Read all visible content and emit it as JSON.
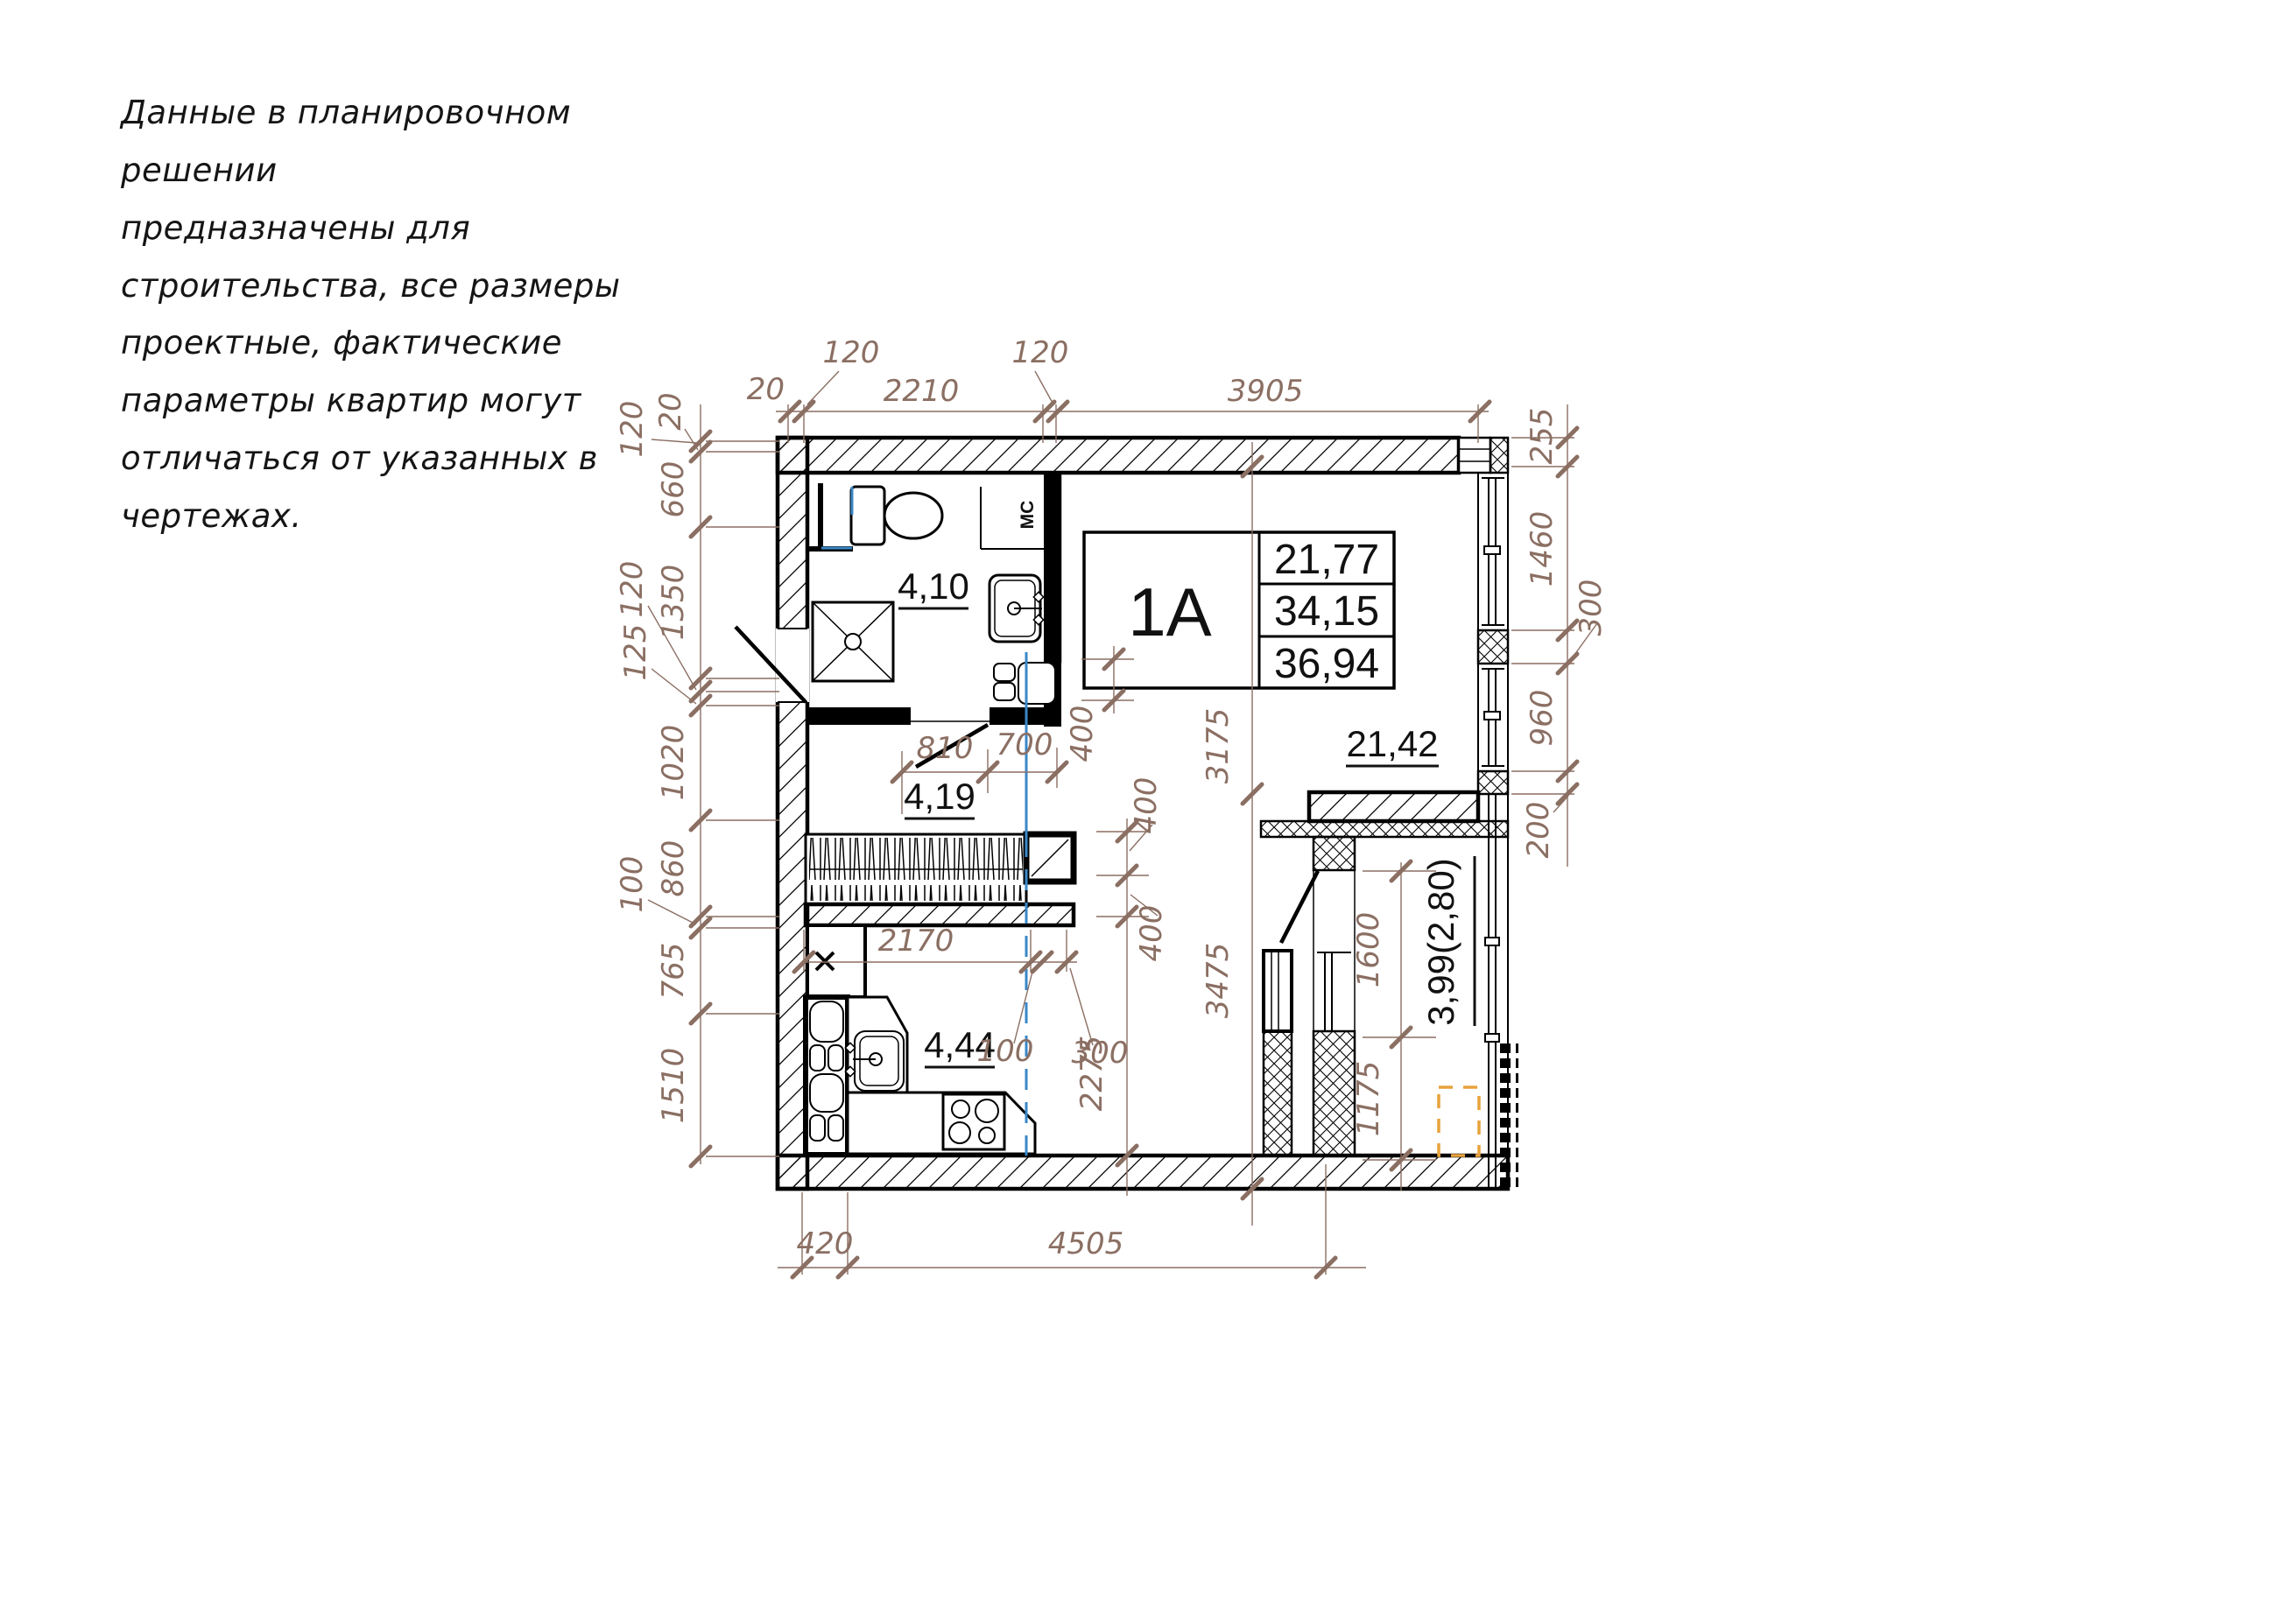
{
  "disclaimer": {
    "text": "Данные в планировочном решении\nпредназначены для\nстроительства, все размеры\nпроектные, фактические\nпараметры квартир могут\nотличаться от указанных в\nчертежах."
  },
  "apartment": {
    "unit_label": "1A",
    "info_table": {
      "rows": [
        "21,77",
        "34,15",
        "36,94"
      ]
    },
    "rooms": [
      {
        "id": "bathroom",
        "area": "4,10"
      },
      {
        "id": "hallway",
        "area": "4,19"
      },
      {
        "id": "kitchen",
        "area": "4,44"
      },
      {
        "id": "living-room",
        "area": "21,42"
      },
      {
        "id": "balcony",
        "area": "3,99(2,80)"
      }
    ],
    "labels": {
      "washing_machine": "МС"
    }
  },
  "dimensions": {
    "top": [
      "20",
      "120",
      "2210",
      "120",
      "3905"
    ],
    "left": [
      "120",
      "20",
      "660",
      "1350",
      "120",
      "125",
      "1020",
      "860",
      "100",
      "765",
      "1510"
    ],
    "right": [
      "255",
      "1460",
      "300",
      "960",
      "200"
    ],
    "bottom": [
      "420",
      "4505"
    ],
    "interior": {
      "hall_a": "810",
      "hall_b": "700",
      "niche_a": "400",
      "niche_b": "400",
      "niche_c": "400",
      "col_upper": "3175",
      "col_lower": "3475",
      "wardrobe": "2170",
      "gap_a": "100",
      "gap_b": "300",
      "kitchen_depth": "2275",
      "balcony_opening": "1600",
      "balcony_pier": "1175"
    }
  },
  "colors": {
    "dimension": "#8B6F63",
    "plan_line": "#000000",
    "door_marker": "#3A87C8",
    "equipment_marker": "#E8A23C"
  }
}
